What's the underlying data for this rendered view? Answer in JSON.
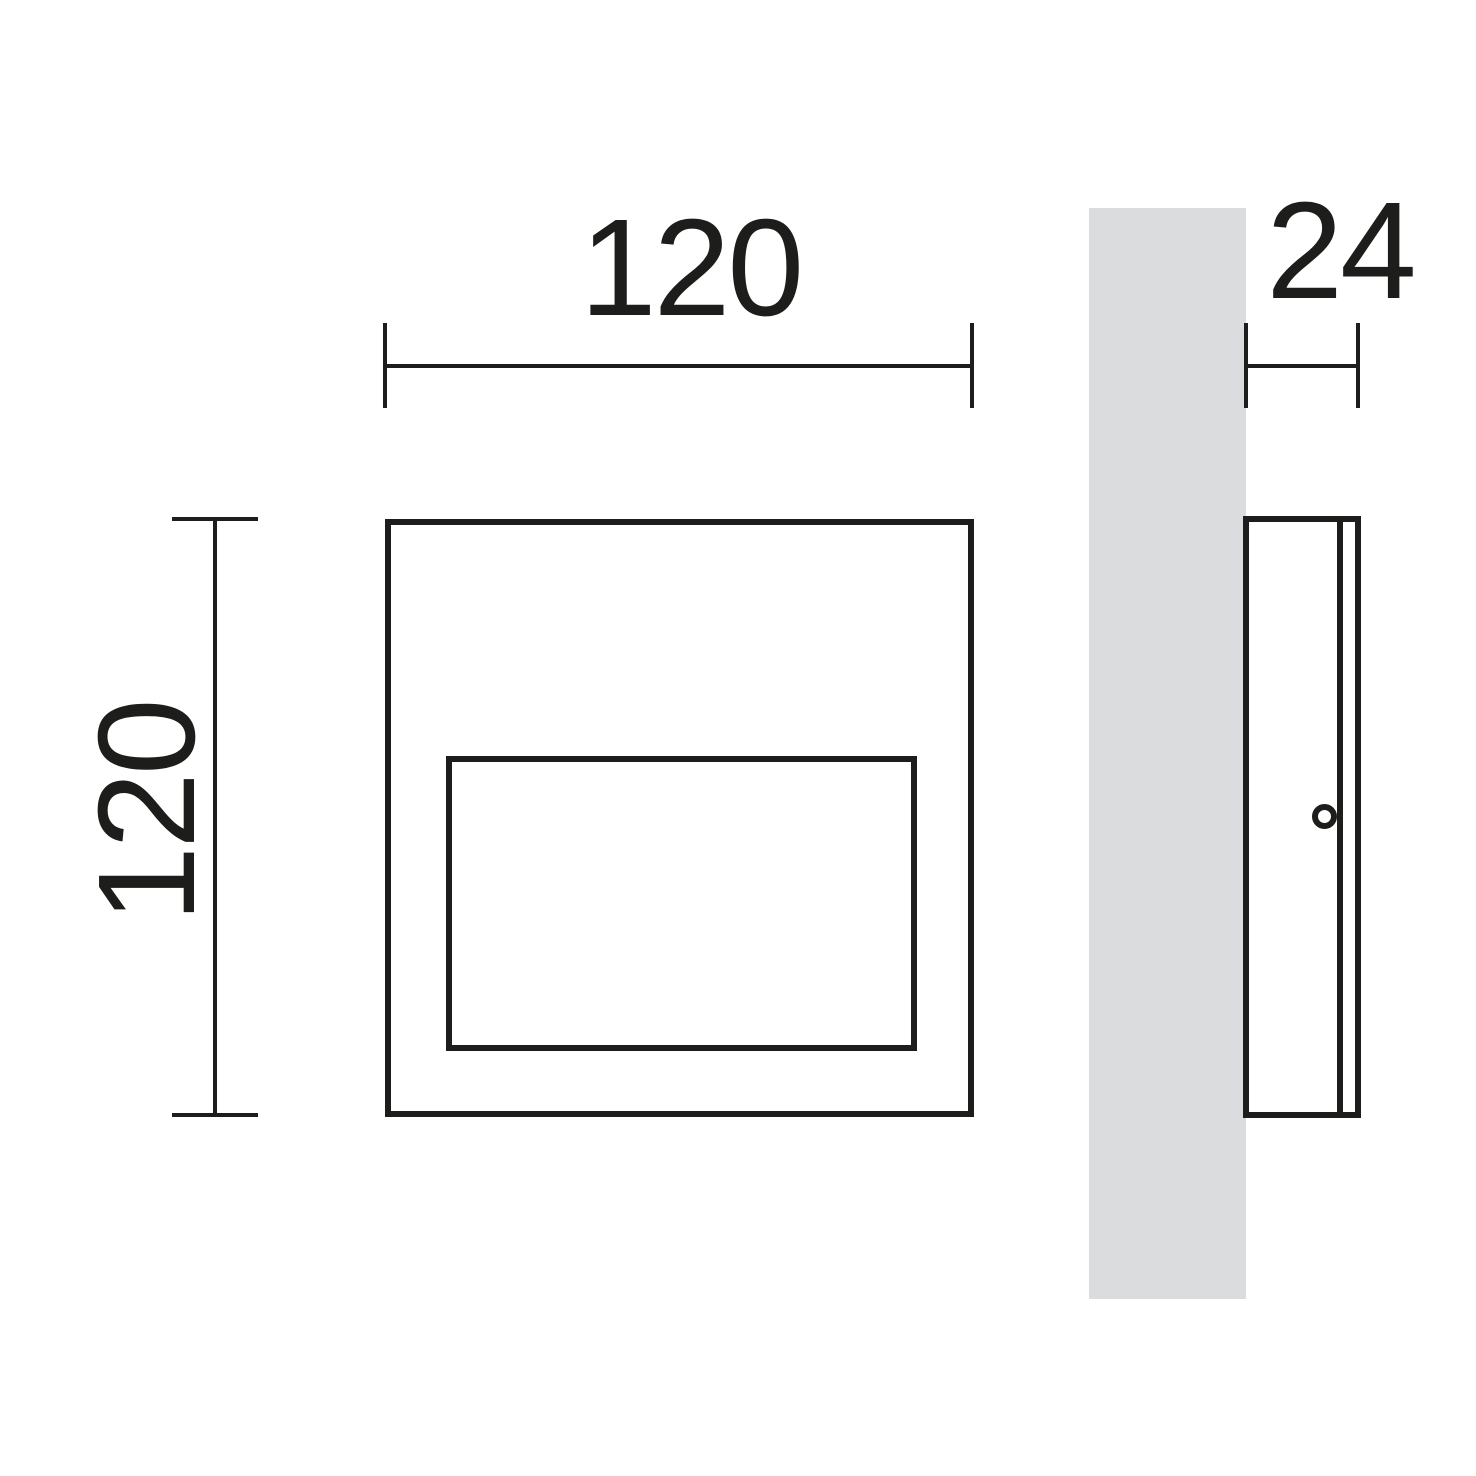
{
  "drawing": {
    "type": "technical-dimension-drawing",
    "subject": "square wall-mounted light fixture, front and side views",
    "views": {
      "front": {
        "width_dimension": {
          "value": "120"
        },
        "height_dimension": {
          "value": "120"
        }
      },
      "side": {
        "depth_dimension": {
          "value": "24"
        }
      }
    },
    "colors": {
      "line": "#1d1d1b",
      "wall_fill": "#dbdcdd",
      "background": "#ffffff"
    }
  }
}
